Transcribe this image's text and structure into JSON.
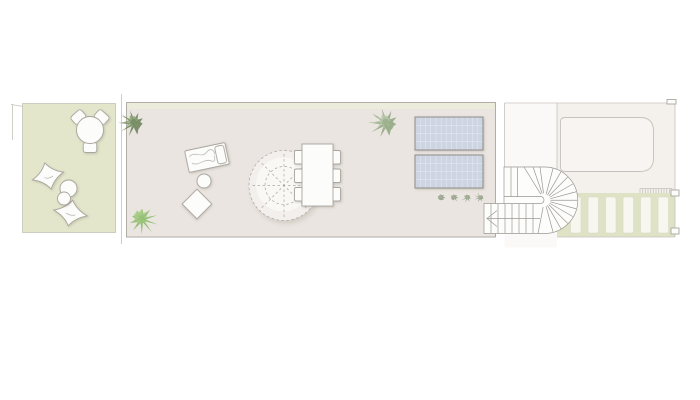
{
  "meta": {
    "type": "architectural-roof-terrace-plan",
    "width": 700,
    "height": 400,
    "visible_text": "none"
  },
  "colors": {
    "background": "#ffffff",
    "garden_green": "#e3e6cb",
    "garden_edge": "#c8c8bc",
    "terrace_beige": "#eae5e0",
    "planter_strip": "#ecefda",
    "pergola_green": "#dfe3c5",
    "slat_white": "#f7f6ef",
    "slat_edge": "#d9d9c7",
    "roof_white": "#f4f1ed",
    "shaft_white": "#fbf9f7",
    "pool_fill": "#f7f4f1",
    "panel_blue": "#cdd4e2",
    "panel_edge": "#8f8d89",
    "panel_grid_c": "#e8ebf2",
    "line_gray": "#aaa69f",
    "hairline_gray": "#c6c2bb",
    "stair_line": "#9b9893",
    "stair_fill": "#fdfdfb",
    "furniture_fill": "#fcfcfa",
    "parasol_fill": "#f2efec",
    "parasol_inner": "#faf8f6"
  },
  "plan": {
    "pergola": {
      "slats_x": [
        570.5,
        588,
        605.5,
        623,
        640.5,
        658
      ],
      "slat_y": 197,
      "slat_w": 10.5,
      "slat_h": 36
    },
    "solar_panels": [
      {
        "x": 415,
        "y": 117,
        "w": 68,
        "h": 33
      },
      {
        "x": 415,
        "y": 155,
        "w": 68,
        "h": 33
      }
    ],
    "panel_grid": {
      "cols": 13,
      "rows": 4
    },
    "plants": [
      {
        "name": "plant-terrace-top-left",
        "cx": 133,
        "cy": 122,
        "r": 16,
        "seed": 1.3,
        "c1": "#6f855e",
        "c2": "#8ba376"
      },
      {
        "name": "plant-terrace-bottom-left",
        "cx": 141,
        "cy": 218,
        "r": 17,
        "seed": 4.1,
        "c1": "#8fbc6e",
        "c2": "#a9cd8a"
      },
      {
        "name": "plant-terrace-right",
        "cx": 385,
        "cy": 122,
        "r": 18,
        "seed": 7.6,
        "c1": "#93a883",
        "c2": "#b3c4a4"
      }
    ],
    "shrub_row": {
      "positions": [
        [
          441,
          197.5
        ],
        [
          454,
          197.5
        ],
        [
          467,
          197.5
        ],
        [
          480,
          197.5
        ]
      ],
      "r": 6.5,
      "c1": "#8d9c82",
      "c2": "#a7b29a"
    },
    "garden": {
      "table": {
        "cx": 90,
        "cy": 130,
        "r": 13.5
      },
      "chairs": [
        {
          "angle": -42
        },
        {
          "angle": 42
        },
        {
          "angle": 180
        }
      ],
      "bean_bags": [
        {
          "cx": 48,
          "cy": 176,
          "rx": 16,
          "ry": 13.5,
          "rot": -14
        },
        {
          "cx": 70.5,
          "cy": 213,
          "rx": 17,
          "ry": 13,
          "rot": 10
        }
      ],
      "poufs": [
        {
          "cx": 68.5,
          "cy": 188.5,
          "r": 8.5
        },
        {
          "cx": 64,
          "cy": 198.5,
          "r": 6.5
        }
      ]
    },
    "dining": {
      "chairs_left_x": 294.5,
      "chairs_right_x": 328.5,
      "chairs_y": [
        150.5,
        169,
        187.5
      ],
      "chair_w": 12,
      "chair_h": 13.5
    },
    "parasol": {
      "cx": 284,
      "cy": 185.5,
      "r_outer": 35,
      "r_inner": 19,
      "spokes": 8
    },
    "stair": {
      "left_top_x": 504,
      "bottom_left_x": 484,
      "top_y": 167,
      "bottom_y": 233.5,
      "notch_y": 203.5,
      "fan_cx": 544.5,
      "fan_cy": 200.25,
      "r_outer": 33.25,
      "top_treads_x": [
        511,
        517.5
      ],
      "fan_top_targets_x": [
        524,
        533,
        540
      ],
      "radial_angles": [
        -75,
        -60,
        -45,
        -30,
        -15,
        0,
        15,
        30,
        45,
        60,
        75
      ],
      "bottom_treads_x": [
        491,
        498,
        505,
        512,
        519,
        526,
        533
      ],
      "fan_bottom_target_x": 538,
      "walk_y": 218.5
    },
    "vent_hatch": {
      "x": 640,
      "y": 188.5,
      "w": 32,
      "h": 5,
      "ticks": 13
    }
  }
}
